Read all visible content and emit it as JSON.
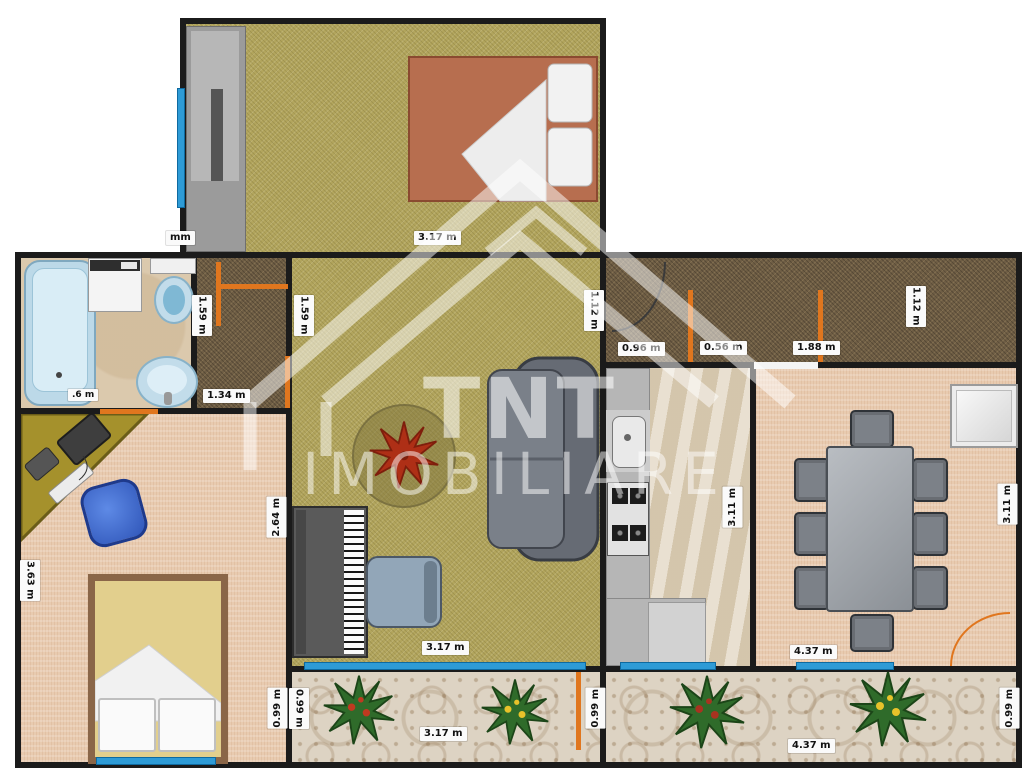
{
  "watermark": {
    "brand": "TNT",
    "name": "IMOBILIARE"
  },
  "dims": {
    "bedroom1_note": "mm",
    "bedroom1_width": "3.17 m",
    "hall1_height_left": "1.59 m",
    "hall1_height_right": "1.59 m",
    "hall1_width": "1.34 m",
    "bathroom_note": ".6 m",
    "living_wall_height": "2.64 m",
    "living_width": "3.17 m",
    "living_top_right_height": "1.12 m",
    "entry_segment_1": "0.96 m",
    "entry_segment_2": "0.56 m",
    "entry_segment_3": "1.88 m",
    "entry_right_height": "1.12 m",
    "kitchen_height": "3.11 m",
    "dining_height": "3.11 m",
    "dining_width": "4.37 m",
    "bedroom2_height": "3.63 m",
    "bedroom2_balcony_height": "0.99 m",
    "balcony_left_height_a": "0.99 m",
    "balcony_left_height_b": "0.99 m",
    "balcony_left_width": "3.17 m",
    "balcony_right_height": "0.99 m",
    "balcony_right_width": "4.37 m"
  },
  "colors": {
    "wall": "#1b1b1b",
    "window": "#2e9bd6",
    "door_accent": "#e0761e",
    "floor_olive": "#b2a55d",
    "floor_hall": "#6f5e45",
    "floor_bathroom": "#dbc9ad",
    "floor_kitchen": "#ddd0b8",
    "floor_bedroom2": "#e8cbb0",
    "floor_balcony": "#ddd3c3",
    "bed1_cover": "#b76e4f",
    "bed2_cover": "#e2cf8d",
    "watermark": "#ffffff"
  }
}
